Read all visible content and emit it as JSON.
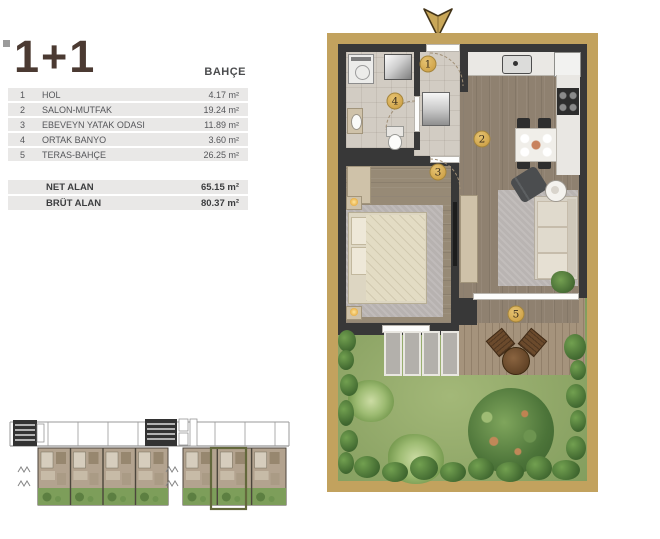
{
  "unit": {
    "title": "1+1",
    "category": "BAHÇE",
    "rooms": [
      {
        "no": "1",
        "name": "HOL",
        "area": "4.17 m²"
      },
      {
        "no": "2",
        "name": "SALON-MUTFAK",
        "area": "19.24 m²"
      },
      {
        "no": "3",
        "name": "EBEVEYN YATAK ODASI",
        "area": "11.89 m²"
      },
      {
        "no": "4",
        "name": "ORTAK BANYO",
        "area": "3.60 m²"
      },
      {
        "no": "5",
        "name": "TERAS-BAHÇE",
        "area": "26.25 m²"
      }
    ],
    "totals": [
      {
        "name": "NET ALAN",
        "area": "65.15 m²"
      },
      {
        "name": "BRÜT ALAN",
        "area": "80.37 m²"
      }
    ]
  },
  "floorplan": {
    "markers": [
      {
        "no": "1",
        "room": "HOL"
      },
      {
        "no": "2",
        "room": "SALON-MUTFAK"
      },
      {
        "no": "3",
        "room": "EBEVEYN YATAK ODASI"
      },
      {
        "no": "4",
        "room": "ORTAK BANYO"
      },
      {
        "no": "5",
        "room": "TERAS-BAHÇE"
      }
    ],
    "colors": {
      "accent_gold": "#c2a25e",
      "marker_gold": "#d0a44a",
      "wall": "#383838",
      "grass": "#90a768",
      "wood_floor": "#8f8170",
      "tile_floor": "#d2ccc3",
      "table_row_bg": "#e9e8e7",
      "title_text": "#4b3a32",
      "keyplan_highlight": "#63683c"
    }
  }
}
